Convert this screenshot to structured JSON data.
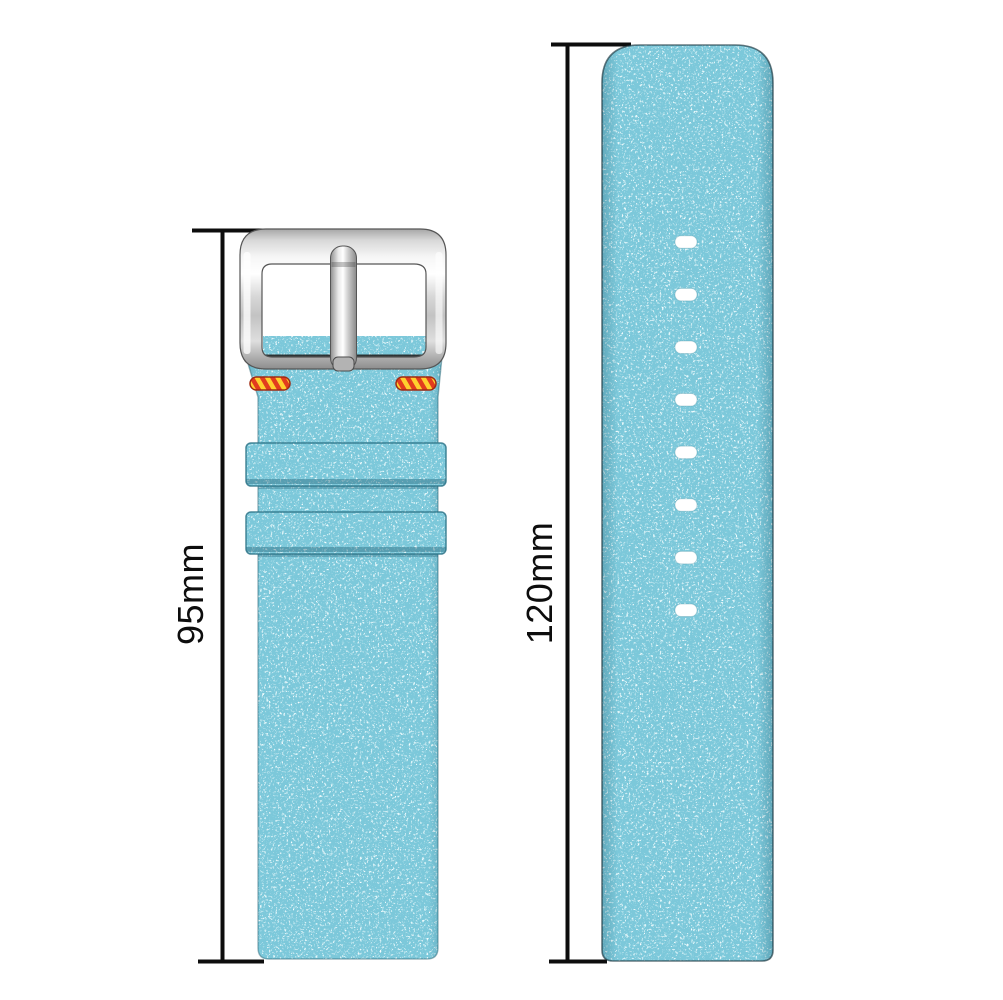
{
  "measurements": {
    "buckle_strap": {
      "label": "95mm"
    },
    "long_strap": {
      "label": "120mm"
    }
  },
  "long_strap": {
    "holes": {
      "count": 8,
      "center_x": 686,
      "first_y": 242,
      "spacing": 52.6,
      "width": 22,
      "height": 12.5,
      "corner_radius": 6
    }
  },
  "colors": {
    "page_bg": "#ffffff",
    "fabric_base": "#7cc8da",
    "fabric_light": "#c2e8f0",
    "fabric_white": "#f4fbfd",
    "fabric_dark": "#2f9fb9",
    "dim_line": "#0d0d0d",
    "stitch_yellow": "#ffd02e",
    "stitch_red": "#e23b1e",
    "hole_color": "#ffffff"
  }
}
